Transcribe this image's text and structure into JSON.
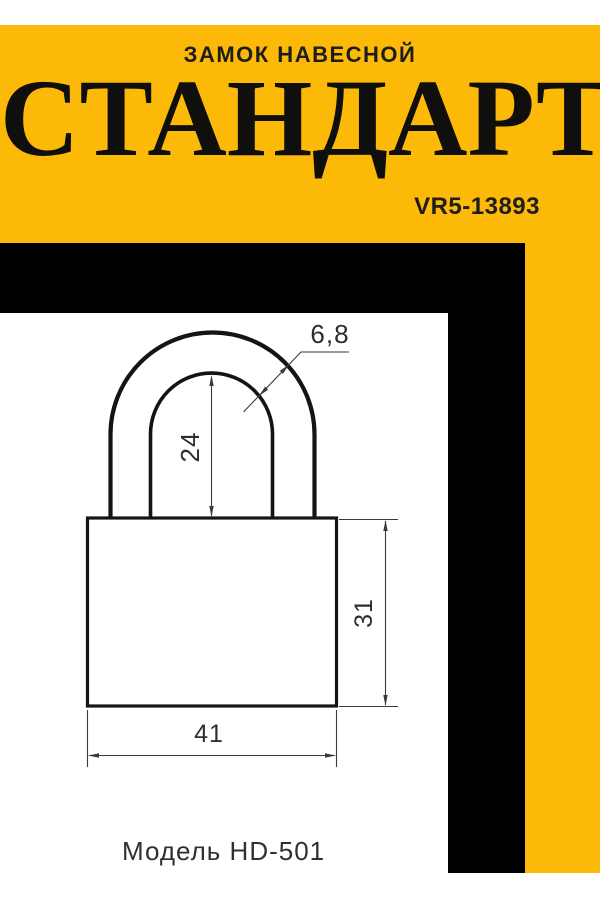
{
  "header": {
    "subtitle": "ЗАМОК НАВЕСНОЙ",
    "title": "СТАНДАРТ",
    "code": "VR5-13893"
  },
  "drawing": {
    "dims": {
      "shackle_diameter": "6,8",
      "shackle_inner_height": "24",
      "body_height": "31",
      "body_width": "41"
    },
    "model_label": "Модель HD-501"
  },
  "colors": {
    "yellow": "#FCB908",
    "black": "#000000",
    "ink": "#1D1D1B",
    "white": "#FFFFFF",
    "line_dark": "#141414",
    "line_dim": "#3A3A3A",
    "text_dim": "#2E2E2E"
  }
}
